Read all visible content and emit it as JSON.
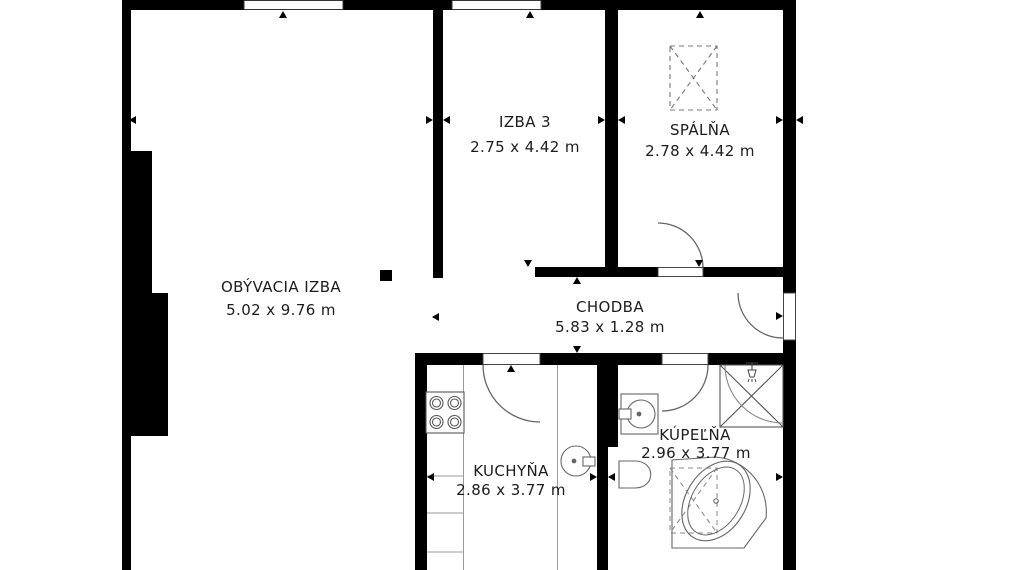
{
  "plan": {
    "type": "apartment-floor-plan",
    "units": "m",
    "rooms": [
      {
        "id": "obyvacia-izba",
        "name": "OBÝVACIA IZBA",
        "dimensions": "5.02 x 9.76 m"
      },
      {
        "id": "izba-3",
        "name": "IZBA 3",
        "dimensions": "2.75 x 4.42 m"
      },
      {
        "id": "spalna",
        "name": "SPÁLŇA",
        "dimensions": "2.78 x 4.42 m"
      },
      {
        "id": "chodba",
        "name": "CHODBA",
        "dimensions": "5.83 x 1.28 m"
      },
      {
        "id": "kuchyna",
        "name": "KUCHYŇA",
        "dimensions": "2.86 x 3.77 m"
      },
      {
        "id": "kupelna",
        "name": "KÚPEĽŇA",
        "dimensions": "2.96 x 3.77 m"
      }
    ],
    "fixtures": [
      "wardrobe-dashed",
      "shower-enclosure",
      "shower-head",
      "washbasin",
      "toilet",
      "corner-bathtub",
      "stove-4-burner",
      "kitchen-sink",
      "kitchen-counter",
      "entry-door",
      "bedroom-door",
      "bathroom-door",
      "kitchen-door",
      "window",
      "window"
    ],
    "colors": {
      "wall": "#000000",
      "background": "#ffffff",
      "fixture_outline": "#666666",
      "counter_line": "#9a9a9a",
      "text": "#1c1c1c"
    }
  }
}
